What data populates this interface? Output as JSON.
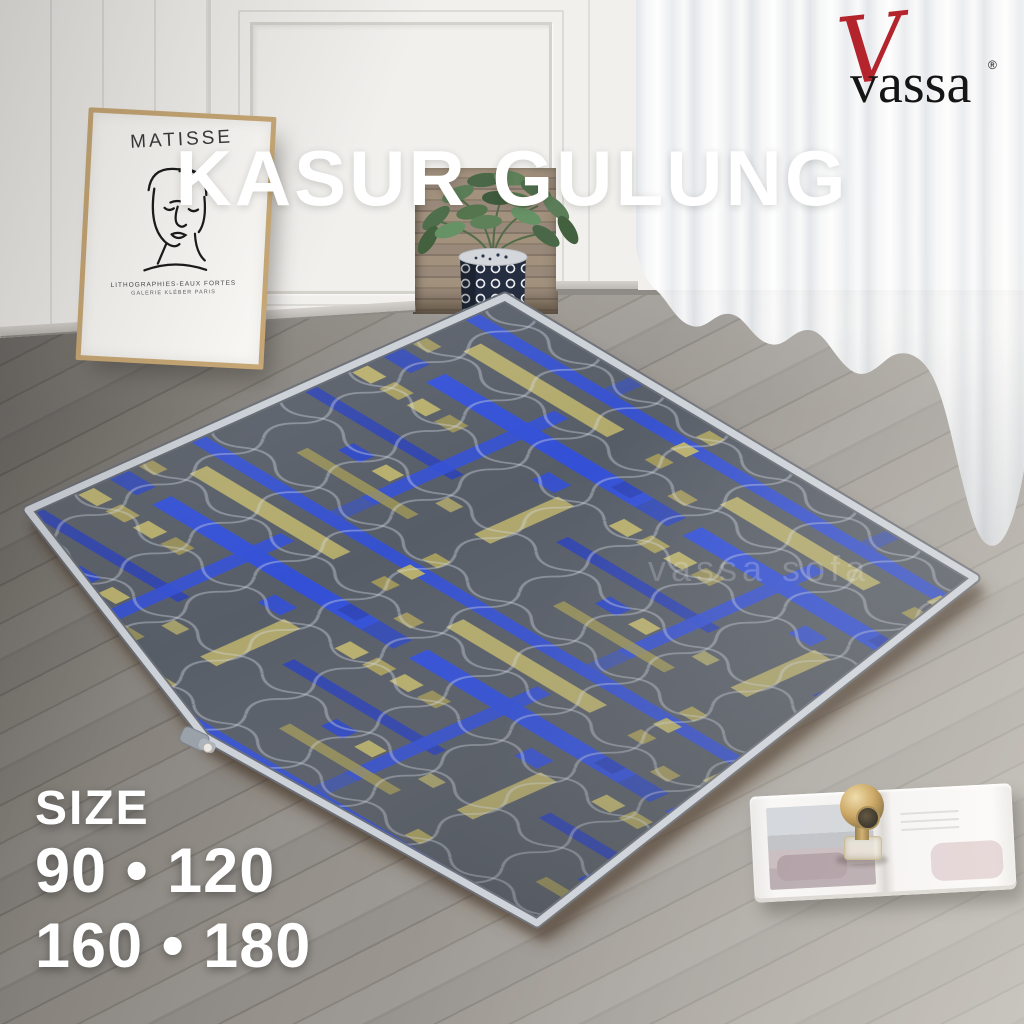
{
  "title_overlay": {
    "text": "KASUR GULUNG",
    "color": "#ffffff"
  },
  "brand_logo": {
    "script_initial": "V",
    "name": "vassa",
    "registered_mark": "®",
    "name_color": "#151515",
    "script_color": "#b3242c"
  },
  "watermark": {
    "text": "vassa sofa"
  },
  "size_panel": {
    "heading": "SIZE",
    "rows": [
      "90 • 120",
      "160 • 180"
    ],
    "sizes": [
      "90",
      "120",
      "160",
      "180"
    ],
    "color": "#ffffff"
  },
  "poster": {
    "artist": "MATISSE",
    "caption_line1": "LITHOGRAPHIES-EAUX FORTES",
    "caption_line2": "GALERIE  KLÉBER  PARIS"
  },
  "palette": {
    "mattress_fabric": "#575d67",
    "mattress_blue": "#3350d6",
    "mattress_gold": "#b7ae6c",
    "mattress_piping": "#cdd2d9",
    "floor_wood": "#8f8b86",
    "wall_white": "#f1f0ed",
    "curtain_white": "#f4f5f6",
    "vase_navy": "#252e40",
    "plant_green": "#55754f",
    "ornament_gold": "#c49a4d"
  }
}
